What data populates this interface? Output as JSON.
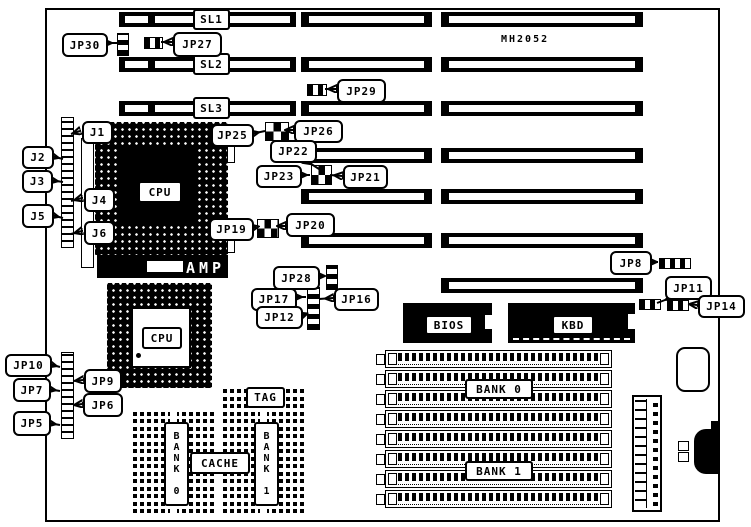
{
  "board": {
    "model": "MH2052"
  },
  "slots": {
    "sl1": "SL1",
    "sl2": "SL2",
    "sl3": "SL3"
  },
  "cpu": {
    "primary_label": "CPU",
    "secondary_label": "CPU",
    "amp": "AMP"
  },
  "chips": {
    "bios": "BIOS",
    "kbd": "KBD"
  },
  "memory": {
    "bank0": "BANK 0",
    "bank1": "BANK 1"
  },
  "cache": {
    "tag": "TAG",
    "cache": "CACHE",
    "bank0": "BANK 0",
    "bank1": "BANK 1"
  },
  "connectors": {
    "j1": "J1",
    "j2": "J2",
    "j3": "J3",
    "j4": "J4",
    "j5": "J5",
    "j6": "J6"
  },
  "jumpers": {
    "jp5": "JP5",
    "jp6": "JP6",
    "jp7": "JP7",
    "jp8": "JP8",
    "jp9": "JP9",
    "jp10": "JP10",
    "jp11": "JP11",
    "jp12": "JP12",
    "jp14": "JP14",
    "jp16": "JP16",
    "jp17": "JP17",
    "jp19": "JP19",
    "jp20": "JP20",
    "jp21": "JP21",
    "jp22": "JP22",
    "jp23": "JP23",
    "jp25": "JP25",
    "jp26": "JP26",
    "jp27": "JP27",
    "jp28": "JP28",
    "jp29": "JP29",
    "jp30": "JP30"
  },
  "colors": {
    "ink": "#000000",
    "paper": "#ffffff"
  }
}
